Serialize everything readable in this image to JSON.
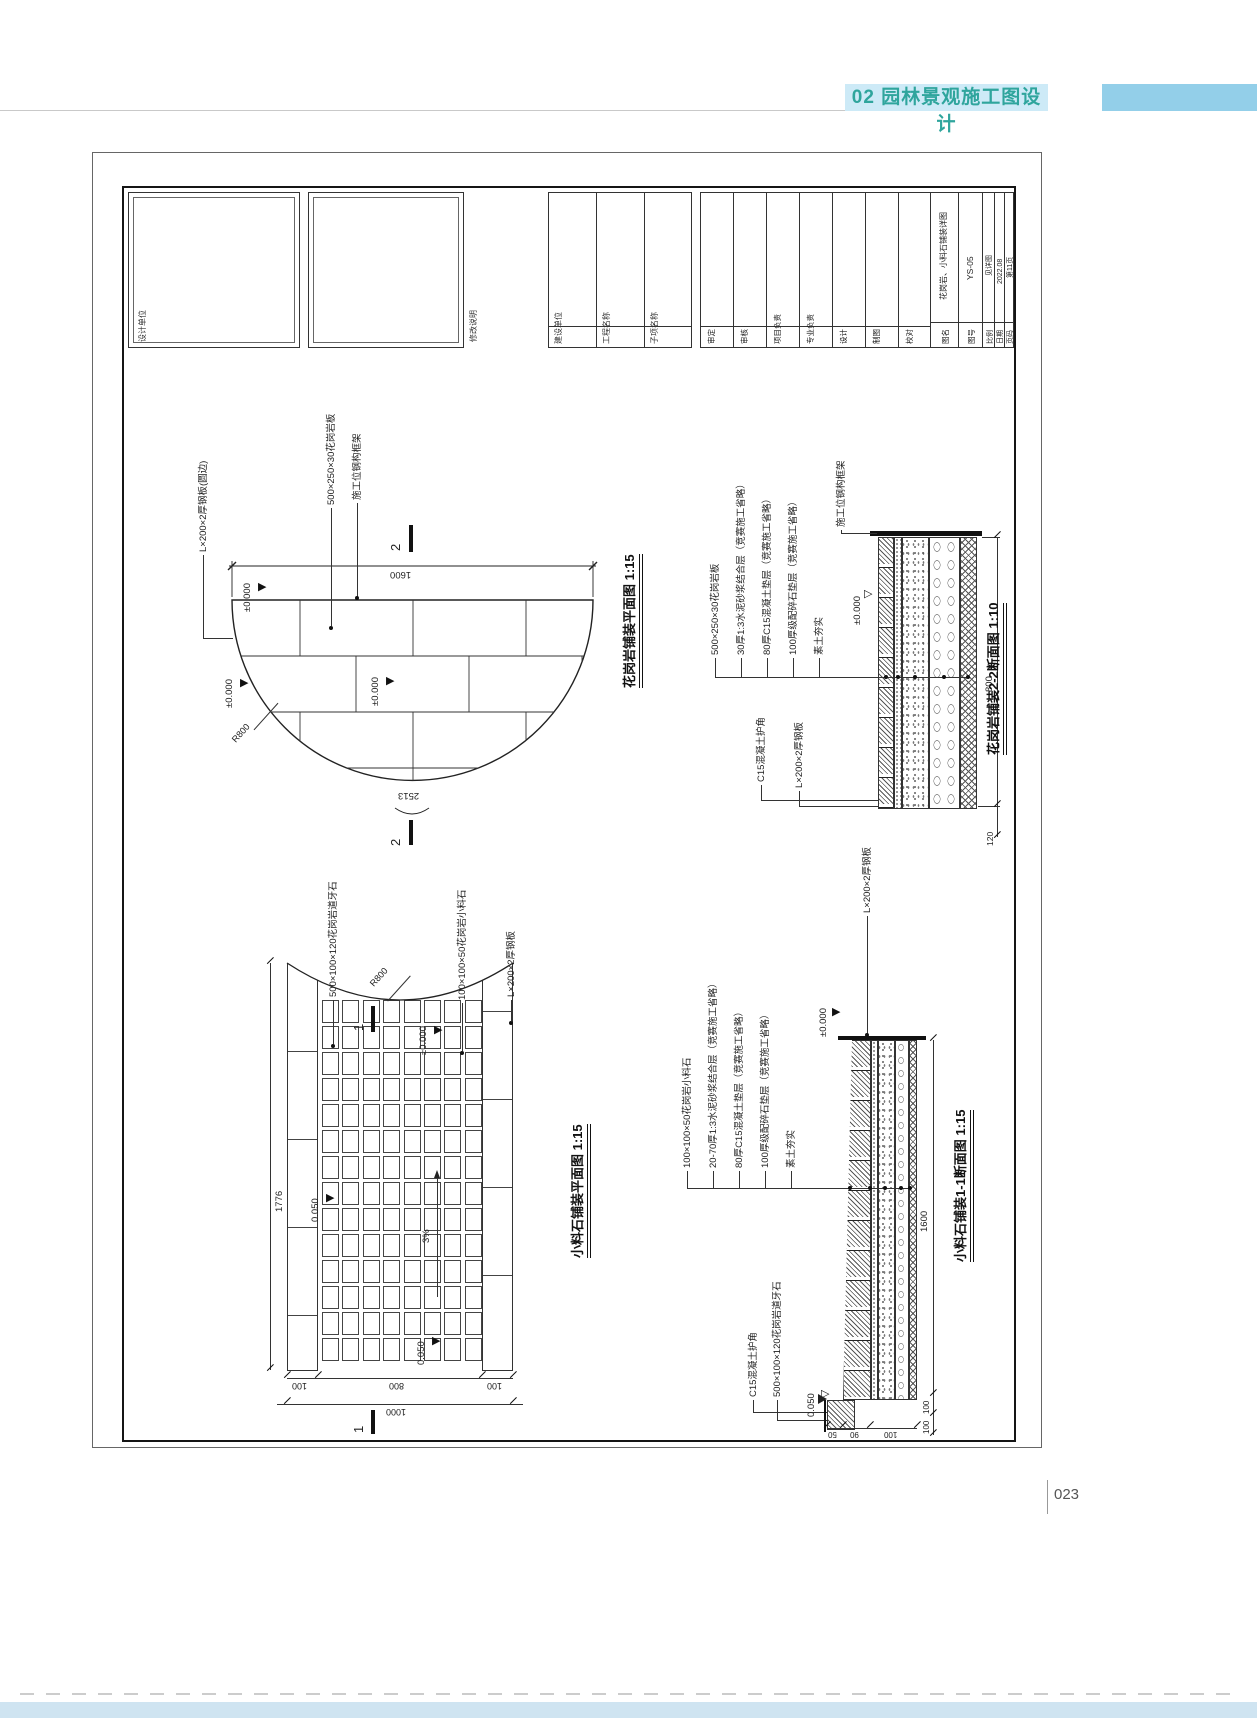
{
  "header": {
    "chapter": "02 园林景观施工图设计"
  },
  "footer": {
    "page_number": "023"
  },
  "colors": {
    "header_bg": "#cdeaf7",
    "header_text": "#2fa59d",
    "header_block": "#93cfe9",
    "footer_band": "#cfe4f1"
  },
  "titleblock": {
    "design_unit": "设计单位",
    "revision": "修改说明",
    "build_cols": [
      "建设单位",
      "工程名称",
      "子项名称"
    ],
    "sig_cols": [
      "审定",
      "审核",
      "项目负责",
      "专业负责",
      "设计",
      "制图",
      "校对"
    ],
    "info_labels": [
      "图名",
      "图号",
      "比例",
      "日期",
      "页码"
    ],
    "info_values": [
      "花岗岩、小料石铺装详图",
      "YS-05",
      "见详图",
      "2022.08",
      "第11页"
    ]
  },
  "plan1": {
    "title": "花岗岩铺装平面图 1:15",
    "lbl_slab": "500×250×30花岗岩板",
    "lbl_frame": "施工位钢构框架",
    "lbl_steel": "L×200×2厚钢板(圆边)",
    "elev": "±0.000",
    "dim_width": "1600",
    "dim_arc": "2513",
    "dim_radius": "R800",
    "mark": "2"
  },
  "sec22": {
    "title": "花岗岩铺装2-2断面图 1:10",
    "layers": [
      "500×250×30花岗岩板",
      "30厚1:3水泥砂浆结合层（竞赛施工省略）",
      "80厚C15混凝土垫层（竞赛施工省略）",
      "100厚级配碎石垫层（竞赛施工省略）",
      "素土夯实"
    ],
    "lbl_frame": "施工位钢构框架",
    "elev": "±0.000",
    "lbl_corner": "C15混凝土护角",
    "lbl_steel": "L×200×2厚钢板",
    "dim_depth": "800",
    "dim_edge": "120"
  },
  "plan2": {
    "title": "小料石铺装平面图 1:15",
    "lbl_curb": "500×100×120花岗岩道牙石",
    "lbl_radius": "R800",
    "lbl_stone": "100×100×50花岗岩小料石",
    "lbl_steel": "L×200×2厚钢板",
    "elev": "±0.000",
    "elev2": "0.050",
    "slope": "3%",
    "dim_len": "1776",
    "dims_bottom": [
      "100",
      "800",
      "100"
    ],
    "dim_total": "1000",
    "mark": "1"
  },
  "sec11": {
    "title": "小料石铺装1-1断面图 1:15",
    "layers": [
      "100×100×50花岗岩小料石",
      "20-70厚1:3水泥砂浆结合层（竞赛施工省略）",
      "80厚C15混凝土垫层（竞赛施工省略）",
      "100厚级配碎石垫层（竞赛施工省略）",
      "素土夯实"
    ],
    "lbl_steel": "L×200×2厚钢板",
    "elev": "±0.000",
    "elev2": "0.050",
    "lbl_corner": "C15混凝土护角",
    "lbl_curb": "500×100×120花岗岩道牙石",
    "dim_len": "1600",
    "dim_d1": "100",
    "dim_d2": "100",
    "dims_bottom": [
      "50",
      "90",
      "100"
    ]
  }
}
